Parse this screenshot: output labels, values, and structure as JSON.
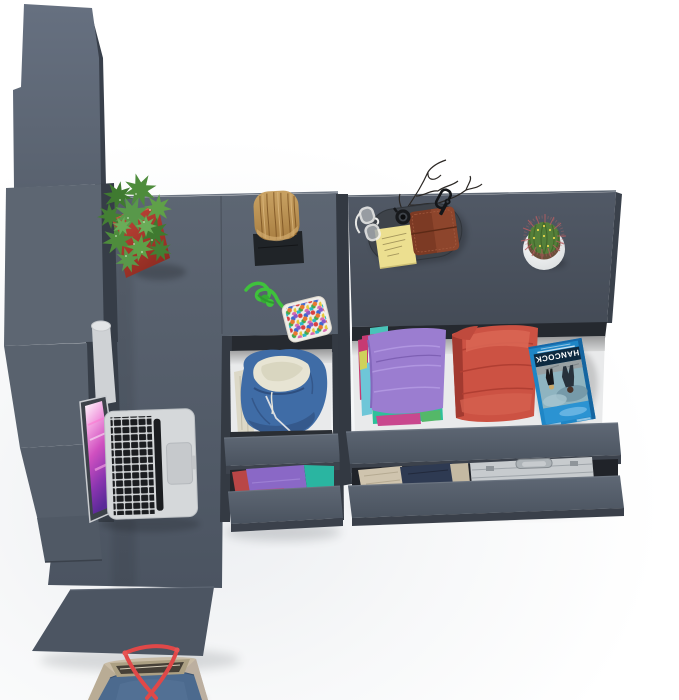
{
  "scene": {
    "label": "Top-down 3D render of an anthracite-gray corner desk set with tall wardrobe column, pedestal drawers and a dresser, drawers open showing folded clothes",
    "objects": [
      "wardrobe-column",
      "corner-desk",
      "desk-return",
      "pedestal-drawers",
      "dresser",
      "macbook-laptop",
      "red-planter-succulent",
      "wooden-stool",
      "paracord",
      "bead-box",
      "blue-hoodie",
      "folded-purple-shirts",
      "folded-coral-towels",
      "hancock-bluray-case",
      "khaki-clothes",
      "aluminum-briefcase",
      "valet-tray",
      "sunglasses",
      "wrist-watch",
      "key-carabiner",
      "sticky-note",
      "leather-wallet",
      "decorative-twigs",
      "cactus-white-pot",
      "canvas-tote-bag"
    ]
  },
  "bluray": {
    "title": "HANCOCK"
  },
  "colors": {
    "bg": "#ffffff",
    "desk": "#57606d",
    "desk_edge": "#6e7784",
    "furniture_dark": "#3a414c",
    "furniture_darker": "#262a30",
    "dresser_top": "#4a525e",
    "drawer_front": "#59626f",
    "drawer_interior": "#e9eaeb",
    "hoodie_blue": "#3f6ca6",
    "hoodie_lining": "#e7e4d3",
    "shirt_purple": "#9b7dd0",
    "towel_coral": "#cc5243",
    "teal": "#2ec09a",
    "pink": "#c73a72",
    "cyan": "#6ec6d8",
    "bluray_blue": "#1f86c6",
    "bluray_sky": "#2b93d2",
    "pot_red": "#b23b2f",
    "plant_green": "#4e8c3c",
    "wood": "#b98d4e",
    "mat_black": "#202428",
    "cord_green": "#3fc13c",
    "pot_white": "#f2f3f4",
    "cactus_green": "#55803a",
    "spine_red": "#b85c60",
    "note_yellow": "#ecdf90",
    "wallet_brown": "#7c3a24",
    "tray_dark": "#3e434a",
    "laptop_silver": "#d5d8da",
    "key_black": "#1b1d20",
    "screen_magenta": "#c13fb0",
    "bag_beige": "#c9bca6",
    "bag_denim": "#4c6a8e",
    "strap_red": "#e04848",
    "briefcase_silver": "#c7cbce",
    "khaki": "#cfc4ae",
    "navy": "#2e3a52"
  }
}
